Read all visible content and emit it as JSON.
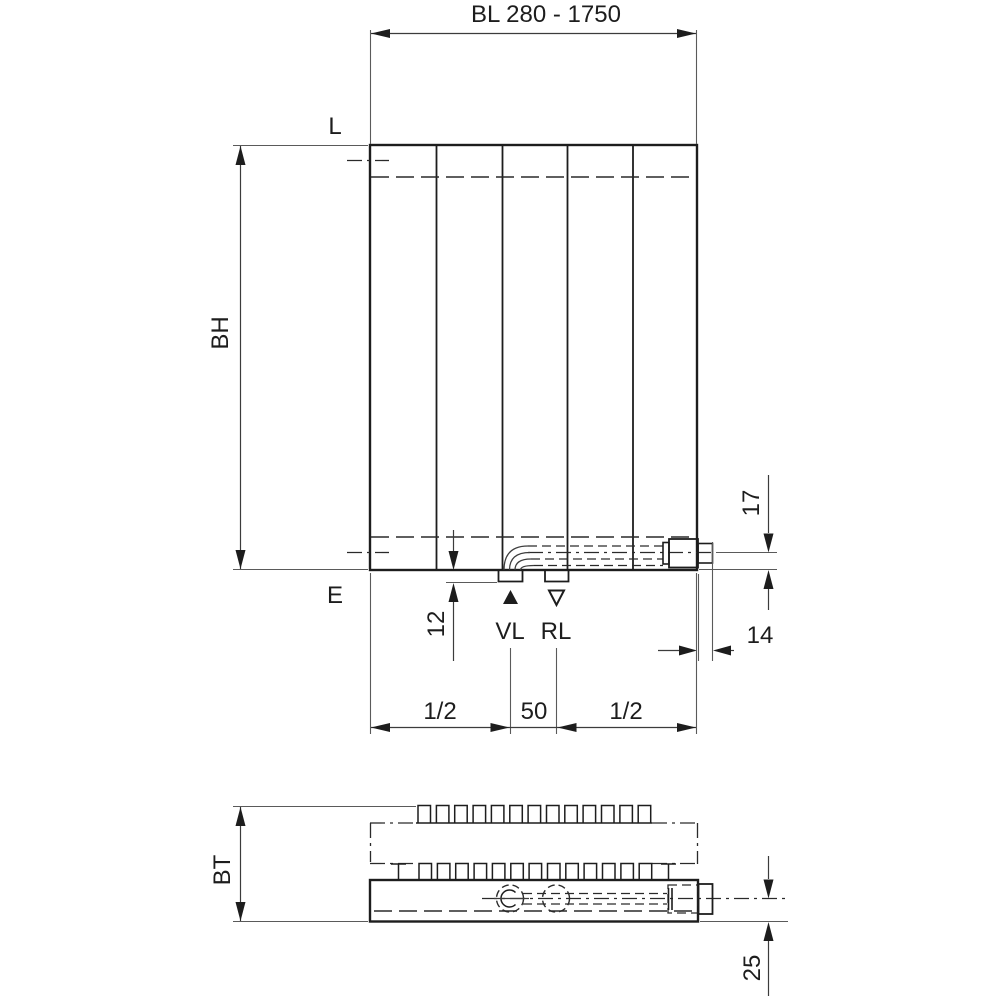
{
  "labels": {
    "overall_length": "BL 280 - 1750",
    "top_left": "L",
    "bottom_left": "E",
    "height": "BH",
    "depth": "BT",
    "flow": "VL",
    "return_flow": "RL"
  },
  "dimensions": {
    "stub_offset": "12",
    "pipe_center_height": "17",
    "stub_protrusion": "14",
    "pipe_center_depth": "25",
    "connection_spacing": "50",
    "half_left": "1/2",
    "half_right": "1/2"
  },
  "icons": {
    "flow_marker": "filled-up-triangle-icon",
    "return_marker": "open-down-triangle-icon"
  },
  "colors": {
    "line": "#1d1d1d",
    "background": "#ffffff"
  }
}
